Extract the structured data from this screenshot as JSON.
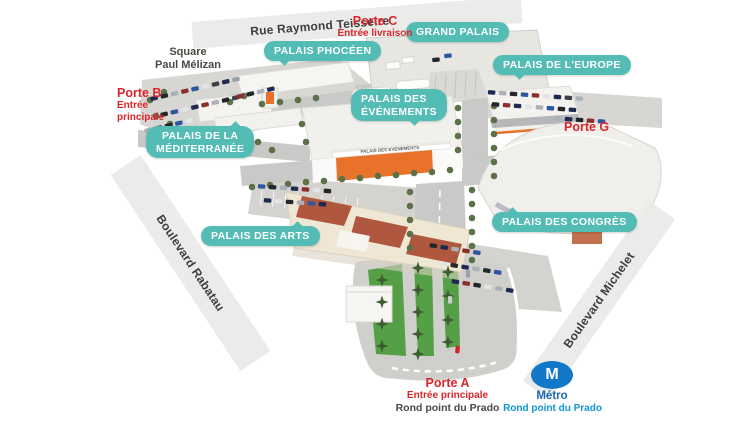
{
  "colors": {
    "venue_label_bg": "#53bcb5",
    "venue_label_text": "#ffffff",
    "gate_text": "#d9262b",
    "street_band_bg": "#ebebea",
    "street_text": "#3e3e3c",
    "muted_text": "#4c4944",
    "metro_badge_bg": "#1478c8",
    "metro_name_text": "#1e66b2",
    "metro_station_text": "#0f96d6",
    "building_accent_orange": "#e8722a"
  },
  "streets": {
    "teisseire": {
      "label": "Rue Raymond Teisseire"
    },
    "rabatau": {
      "label": "Boulevard Rabatau"
    },
    "michelet": {
      "label": "Boulevard Michelet"
    }
  },
  "landmarks": {
    "square_paul_melizan": {
      "line1": "Square",
      "line2": "Paul Mélizan"
    }
  },
  "venues": {
    "grand_palais": {
      "label": "GRAND PALAIS"
    },
    "palais_phoceen": {
      "label": "PALAIS PHOCÉEN"
    },
    "palais_europe": {
      "label": "PALAIS DE L'EUROPE"
    },
    "palais_evenements": {
      "line1": "PALAIS DES",
      "line2": "ÉVÉNEMENTS"
    },
    "palais_mediterranee": {
      "line1": "PALAIS DE LA",
      "line2": "MÉDITERRANÉE"
    },
    "palais_congres": {
      "label": "PALAIS DES CONGRÈS"
    },
    "palais_arts": {
      "label": "PALAIS DES ARTS"
    }
  },
  "gates": {
    "porte_c": {
      "name": "Porte C",
      "detail": "Entrée livraison"
    },
    "porte_b": {
      "name": "Porte B",
      "detail_line1": "Entrée",
      "detail_line2": "principale"
    },
    "porte_g": {
      "name": "Porte G"
    },
    "porte_a": {
      "name": "Porte A",
      "detail": "Entrée principale",
      "location": "Rond point du Prado"
    }
  },
  "metro": {
    "symbol": "M",
    "name": "Métro",
    "station": "Rond point du Prado"
  },
  "scene": {
    "evenements_facade_sign": "PALAIS DES EVENEMENTS"
  }
}
